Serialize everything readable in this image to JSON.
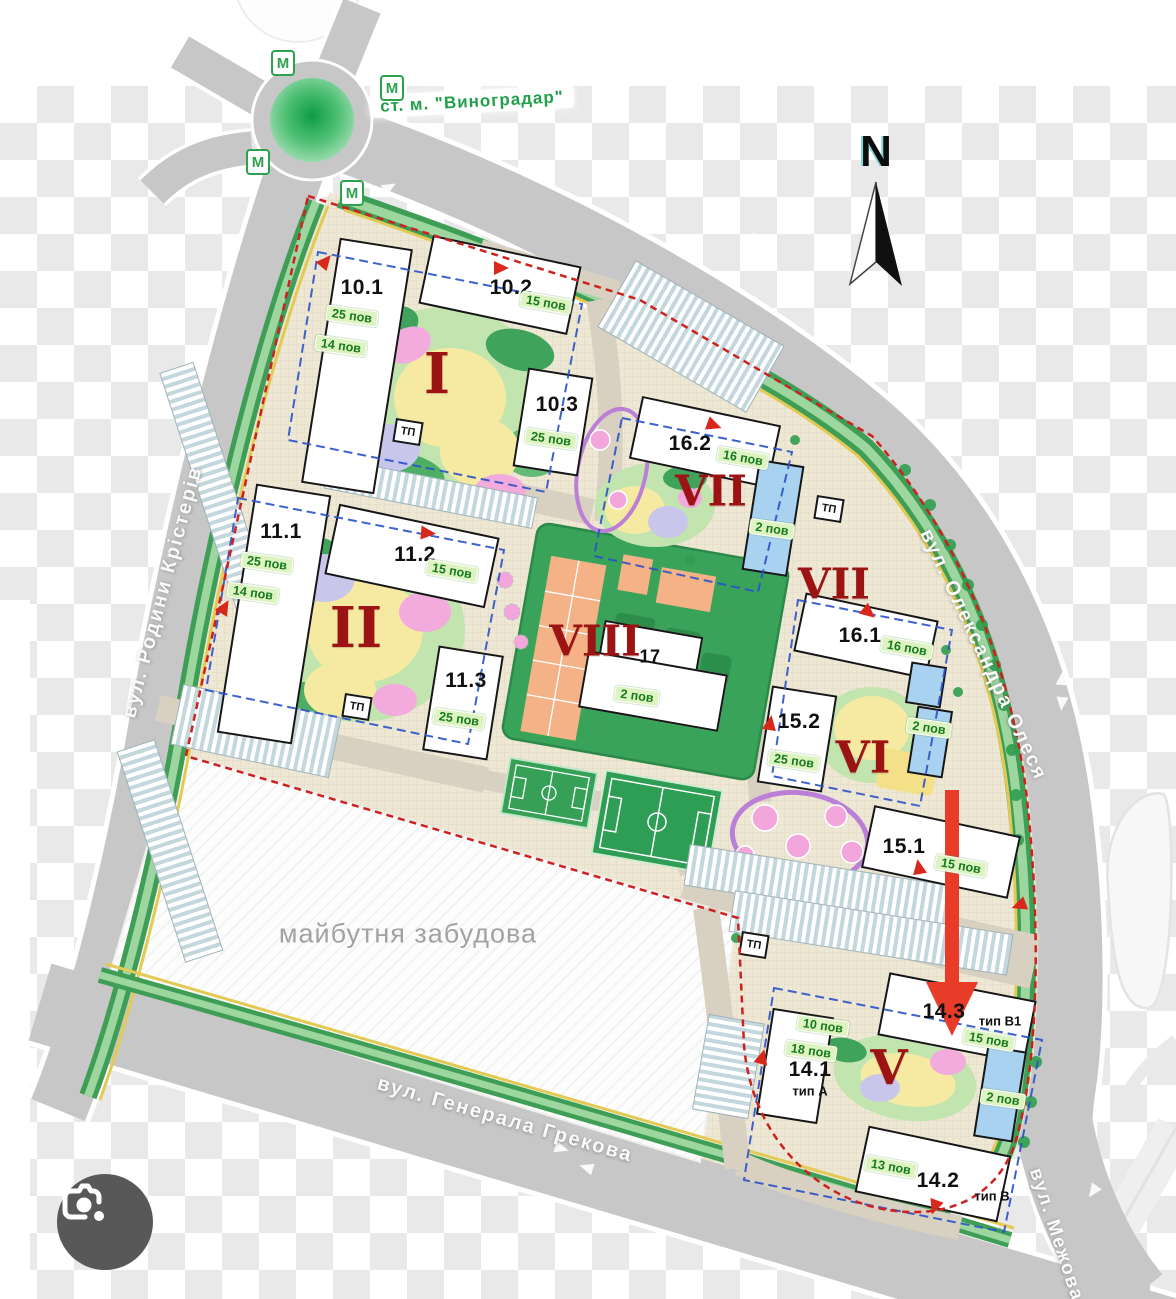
{
  "meta": {
    "station": "ст. м. \"Виноградар\"",
    "metro_m": "М",
    "north": "N",
    "future_area": "майбутня забудова",
    "tp": "ТП"
  },
  "streets": {
    "kristeriv": "вул. Родини Крістерів",
    "olesya": "вул. Олександра Олеся",
    "grekova": "вул. Генерала Грекова",
    "mezhova": "вул. Межова"
  },
  "sections": {
    "s1": "I",
    "s2": "II",
    "s5": "V",
    "s6": "VI",
    "s7a": "VII",
    "s7b": "VII",
    "s8": "VIII"
  },
  "buildings": {
    "b101": {
      "num": "10.1",
      "f1": "25 пов",
      "f2": "14 пов"
    },
    "b102": {
      "num": "10.2",
      "f1": "15 пов"
    },
    "b103": {
      "num": "10.3",
      "f1": "25 пов"
    },
    "b111": {
      "num": "11.1",
      "f1": "25 пов",
      "f2": "14 пов"
    },
    "b112": {
      "num": "11.2",
      "f1": "15 пов"
    },
    "b113": {
      "num": "11.3",
      "f1": "25 пов"
    },
    "b162": {
      "num": "16.2",
      "f1": "16 пов"
    },
    "b161": {
      "num": "16.1",
      "f1": "16 пов"
    },
    "b152": {
      "num": "15.2",
      "f1": "25 пов"
    },
    "b151": {
      "num": "15.1",
      "f1": "15 пов"
    },
    "b17": {
      "num": "17",
      "f1": "2 пов"
    },
    "b141": {
      "num": "14.1",
      "type": "тип А",
      "f1": "10 пов",
      "f2": "18 пов"
    },
    "b143": {
      "num": "14.3",
      "type": "тип В1",
      "f1": "15 пов"
    },
    "b142": {
      "num": "14.2",
      "type": "тип В",
      "f1": "13 пов"
    },
    "blue1": {
      "f1": "2 пов"
    },
    "blue2": {
      "f1": "2 пов"
    },
    "blue3": {
      "f1": "2 пов"
    }
  },
  "colors": {
    "road": "#c7c7c7",
    "site": "#ede7d4",
    "lawn_green": "#3f9e55",
    "boundary_red": "#cf2020",
    "arrow_red": "#e83c28",
    "metro_green": "#23a24d",
    "blue_building": "#a9d2f0",
    "pill_bg": "#def3c2",
    "pill_text": "#157a1b",
    "section_red": "#9c1313"
  }
}
